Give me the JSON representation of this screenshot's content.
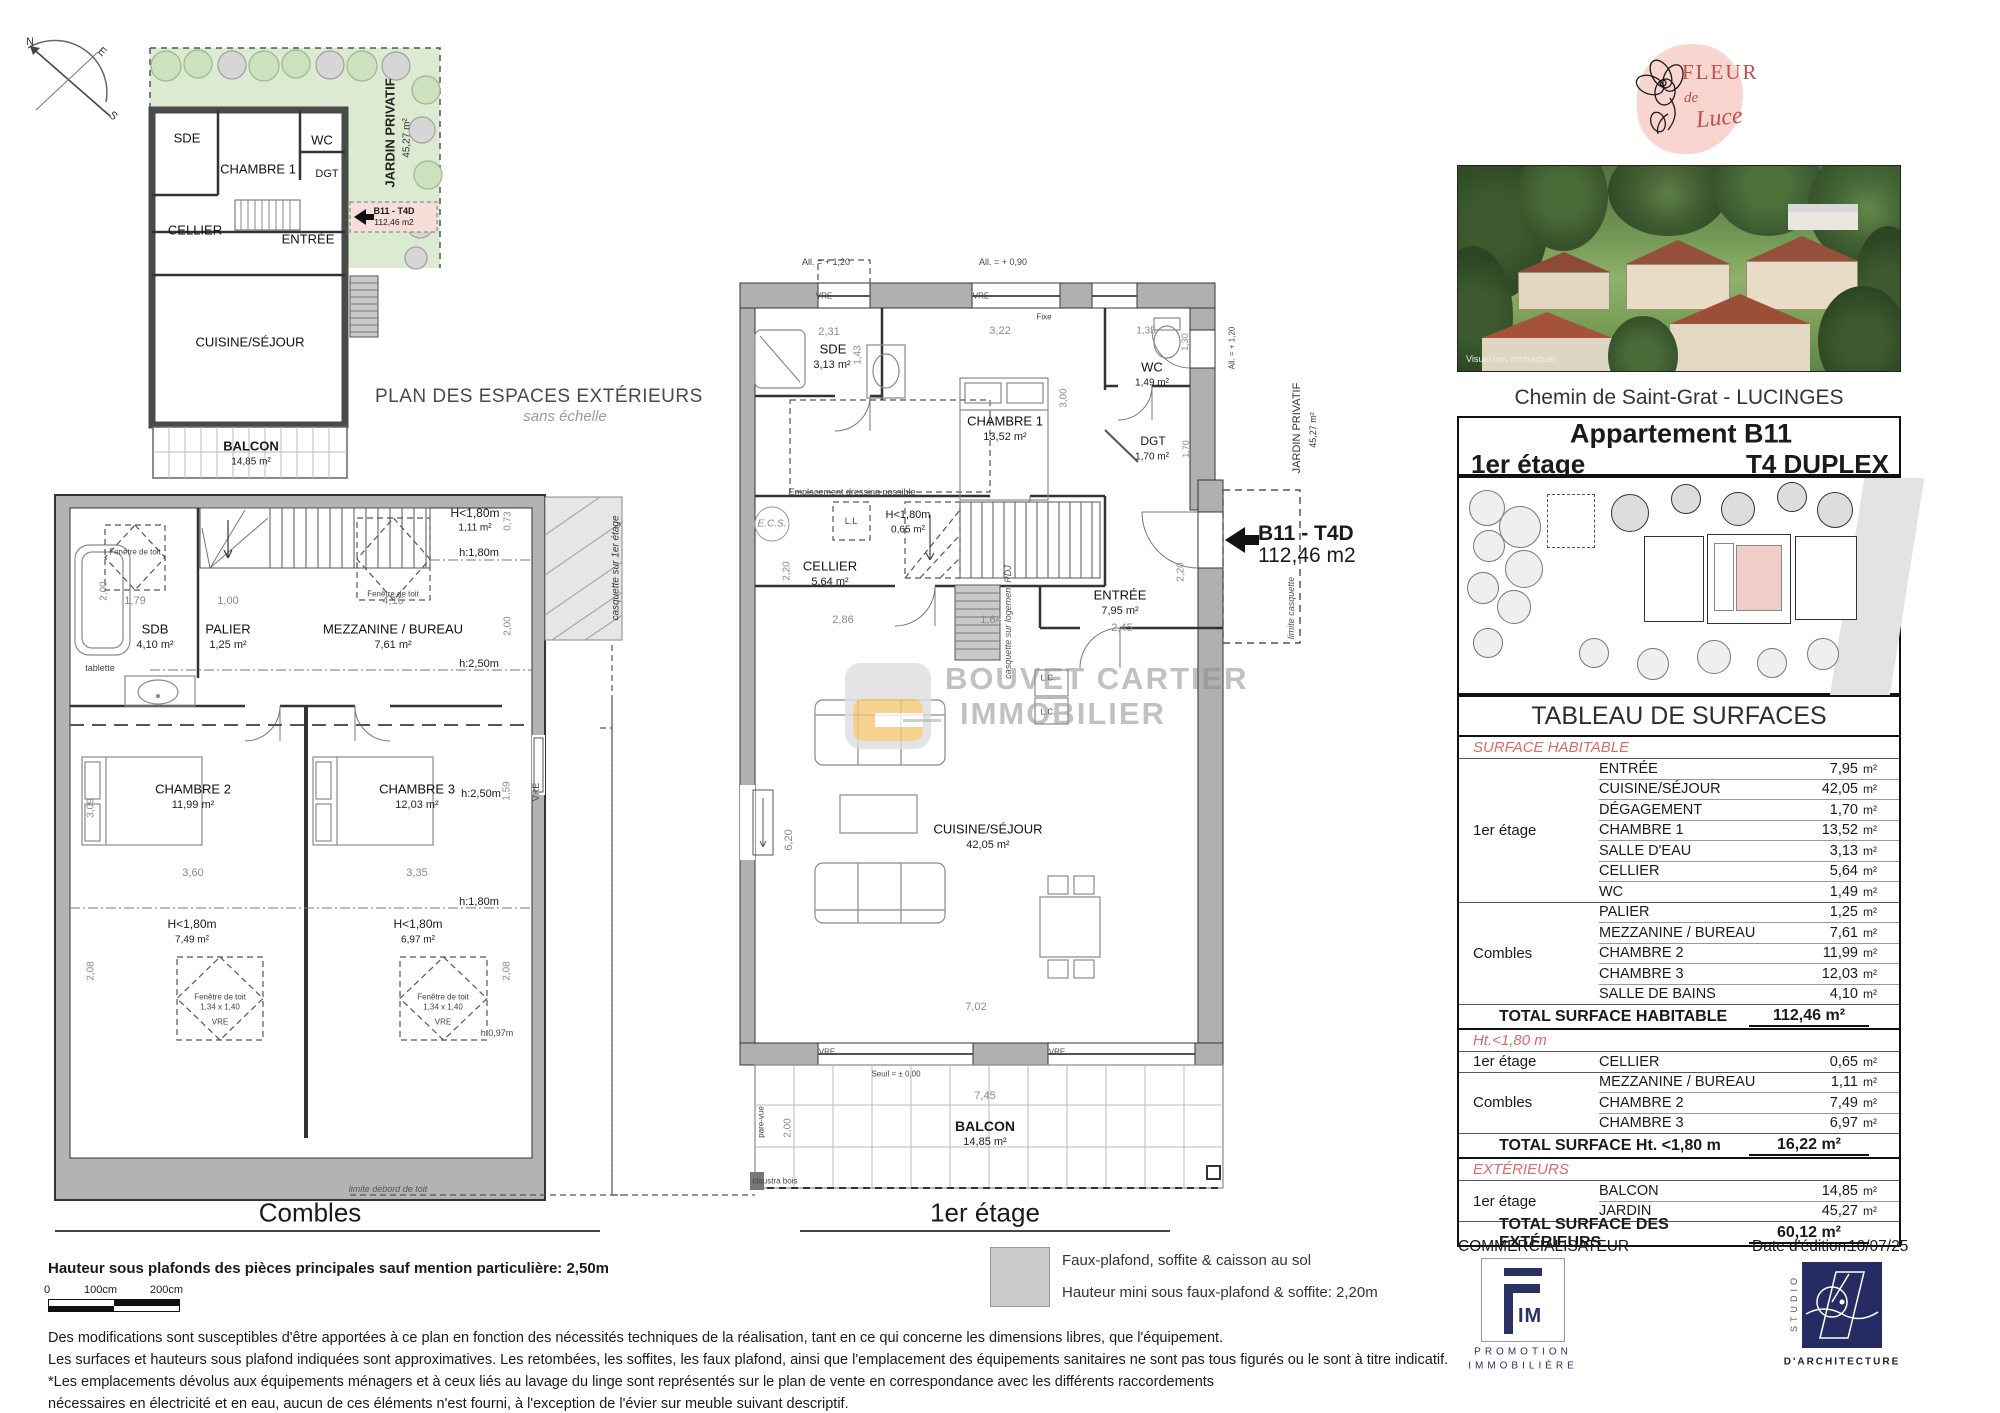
{
  "compass": {
    "n": "N",
    "e": "E",
    "s": "S"
  },
  "exterior": {
    "title": "PLAN DES ESPACES EXTÉRIEURS",
    "subtitle": "sans échelle",
    "jardin": "JARDIN PRIVATIF",
    "jardin_area": "45,27 m²",
    "rooms": {
      "sde": "SDE",
      "ch1": "CHAMBRE 1",
      "wc": "WC",
      "dgt": "DGT",
      "cellier": "CELLIER",
      "entree": "ENTRÉE",
      "cuisine": "CUISINE/SÉJOUR"
    },
    "balcon": {
      "n": "BALCON",
      "a": "14,85 m²"
    },
    "tag": {
      "code": "B11 - T4D",
      "area": "112,46 m2"
    }
  },
  "combles": {
    "title": "Combles",
    "sdb": {
      "n": "SDB",
      "a": "4,10 m²"
    },
    "palier": {
      "n": "PALIER",
      "a": "1,25 m²"
    },
    "mezz": {
      "n": "MEZZANINE / BUREAU",
      "a": "7,61 m²"
    },
    "ch2": {
      "n": "CHAMBRE 2",
      "a": "11,99 m²"
    },
    "ch3": {
      "n": "CHAMBRE 3",
      "a": "12,03 m²"
    },
    "h180top": {
      "n": "H<1,80m",
      "a": "1,11 m²"
    },
    "h180l": {
      "n": "H<1,80m",
      "a": "7,49 m²"
    },
    "h180r": {
      "n": "H<1,80m",
      "a": "6,97 m²"
    },
    "txt": {
      "tablette": "tablette",
      "h250": "h:2,50m",
      "h180": "h:1,80m",
      "h097": "h:0,97m",
      "fen": "Fenêtre de toit",
      "fen_dim_top": "1,14 x 1,18",
      "fen_dim": "1,34 x 1,40",
      "vre": "VRE",
      "casquette": "casquette sur 1er étage",
      "limite": "limite débord de toit"
    },
    "dims": {
      "d200l": "2,00",
      "d179": "1,79",
      "d100": "1,00",
      "d416": "4,16",
      "d073": "0,73",
      "d200r": "2,00",
      "d360": "3,60",
      "d335": "3,35",
      "d309": "3,09",
      "d159": "1,59",
      "d208": "2,08"
    }
  },
  "etage": {
    "title": "1er étage",
    "rooms": {
      "sde": {
        "n": "SDE",
        "a": "3,13 m²"
      },
      "ch1": {
        "n": "CHAMBRE 1",
        "a": "13,52 m²"
      },
      "wc": {
        "n": "WC",
        "a": "1,49 m²"
      },
      "dgt": {
        "n": "DGT",
        "a": "1,70 m²"
      },
      "cellier": {
        "n": "CELLIER",
        "a": "5,64 m²"
      },
      "h180": {
        "n": "H<1,80m",
        "a": "0,65 m²"
      },
      "entree": {
        "n": "ENTRÉE",
        "a": "7,95 m²"
      },
      "cuisine": {
        "n": "CUISINE/SÉJOUR",
        "a": "42,05 m²"
      },
      "balcon": {
        "n": "BALCON",
        "a": "14,85 m²"
      }
    },
    "tag": {
      "code": "B11 - T4D",
      "area": "112,46 m2"
    },
    "txt": {
      "ecs": "E.C.S.",
      "ll": "L.L",
      "lc": "L.C.",
      "dressing": "Emplacement dressing possible",
      "seuil": "Seuil = ± 0,00",
      "all120": "All. = + 1,20",
      "all090": "All. = + 0,90",
      "vre": "VRE",
      "fixe": "Fixe",
      "parevue": "pare-vue",
      "claustra": "claustra bois",
      "casqrdj": "casquette sur logement RDJ",
      "limcasq": "limite casquette",
      "jardin": "JARDIN PRIVATIF",
      "jardina": "45,27 m²"
    },
    "dims": {
      "d231": "2,31",
      "d143": "1,43",
      "d322": "3,22",
      "d300": "3,00",
      "d135": "1,35",
      "d130": "1,30",
      "d170": "1,70",
      "d220": "2,20",
      "d286": "2,86",
      "d164": "1,64",
      "d245": "2,45",
      "d620": "6,20",
      "d702": "7,02",
      "d745": "7,45",
      "d200": "2,00"
    }
  },
  "watermark": {
    "line1": "BOUVET CARTIER",
    "line2": "IMMOBILIER"
  },
  "legend": {
    "line1": "Faux-plafond, soffite & caisson au sol",
    "line2": "Hauteur mini sous faux-plafond & soffite: 2,20m"
  },
  "footer": {
    "height_note": "Hauteur sous plafonds des pièces principales sauf mention particulière: 2,50m",
    "scale": {
      "zero": "0",
      "s100": "100cm",
      "s200": "200cm"
    },
    "disclaimer": [
      "Des modifications sont susceptibles d'être apportées à ce plan en fonction des nécessités techniques de la réalisation, tant en ce qui concerne les dimensions libres, que l'équipement.",
      "Les surfaces et hauteurs sous plafond indiquées sont approximatives. Les retombées, les soffites, les faux plafond, ainsi que l'emplacement des équipements sanitaires ne sont pas tous figurés ou le sont à titre indicatif.",
      "*Les emplacements dévolus aux équipements ménagers et à ceux liés au lavage du linge sont représentés sur le plan de vente en correspondance avec les différents raccordements",
      "nécessaires en électricité et en eau, aucun de ces éléments n'est fourni, à l'exception de l'évier sur meuble suivant descriptif."
    ]
  },
  "panel": {
    "brand": {
      "line1": "FLEUR",
      "line2": "de",
      "line3": "Luce"
    },
    "photo_caption": "Visuel non contractuel",
    "address": "Chemin de Saint-Grat - LUCINGES",
    "unit_box": {
      "title": "Appartement B11",
      "floor": "1er étage",
      "type": "T4 DUPLEX"
    },
    "table": {
      "title": "TABLEAU DE SURFACES",
      "unit": "m²",
      "sections": [
        {
          "label": "SURFACE HABITABLE",
          "groups": [
            {
              "floor": "1er étage",
              "rows": [
                [
                  "ENTRÉE",
                  "7,95"
                ],
                [
                  "CUISINE/SÉJOUR",
                  "42,05"
                ],
                [
                  "DÉGAGEMENT",
                  "1,70"
                ],
                [
                  "CHAMBRE 1",
                  "13,52"
                ],
                [
                  "SALLE D'EAU",
                  "3,13"
                ],
                [
                  "CELLIER",
                  "5,64"
                ],
                [
                  "WC",
                  "1,49"
                ]
              ]
            },
            {
              "floor": "Combles",
              "rows": [
                [
                  "PALIER",
                  "1,25"
                ],
                [
                  "MEZZANINE / BUREAU",
                  "7,61"
                ],
                [
                  "CHAMBRE 2",
                  "11,99"
                ],
                [
                  "CHAMBRE 3",
                  "12,03"
                ],
                [
                  "SALLE DE BAINS",
                  "4,10"
                ]
              ]
            }
          ],
          "total_label": "TOTAL SURFACE HABITABLE",
          "total_value": "112,46 m²"
        },
        {
          "label": "Ht.<1,80 m",
          "groups": [
            {
              "floor": "1er étage",
              "rows": [
                [
                  "CELLIER",
                  "0,65"
                ]
              ]
            },
            {
              "floor": "Combles",
              "rows": [
                [
                  "MEZZANINE / BUREAU",
                  "1,11"
                ],
                [
                  "CHAMBRE 2",
                  "7,49"
                ],
                [
                  "CHAMBRE 3",
                  "6,97"
                ]
              ]
            }
          ],
          "total_label": "TOTAL SURFACE Ht. <1,80 m",
          "total_value": "16,22 m²"
        },
        {
          "label": "EXTÉRIEURS",
          "groups": [
            {
              "floor": "1er étage",
              "rows": [
                [
                  "BALCON",
                  "14,85"
                ],
                [
                  "JARDIN",
                  "45,27"
                ]
              ]
            }
          ],
          "total_label": "TOTAL SURFACE DES EXTÉRIEURS",
          "total_value": "60,12 m²"
        }
      ]
    },
    "commercialisateur": "COMMERCIALISATEUR",
    "edition": {
      "label": "Date d'édition:",
      "value": "10/07/25"
    },
    "fim": {
      "im": "IM",
      "sub1": "PROMOTION",
      "sub2": "IMMOBILIÈRE"
    },
    "studio": {
      "vertical": "STUDIO",
      "sub": "D'ARCHITECTURE"
    }
  }
}
